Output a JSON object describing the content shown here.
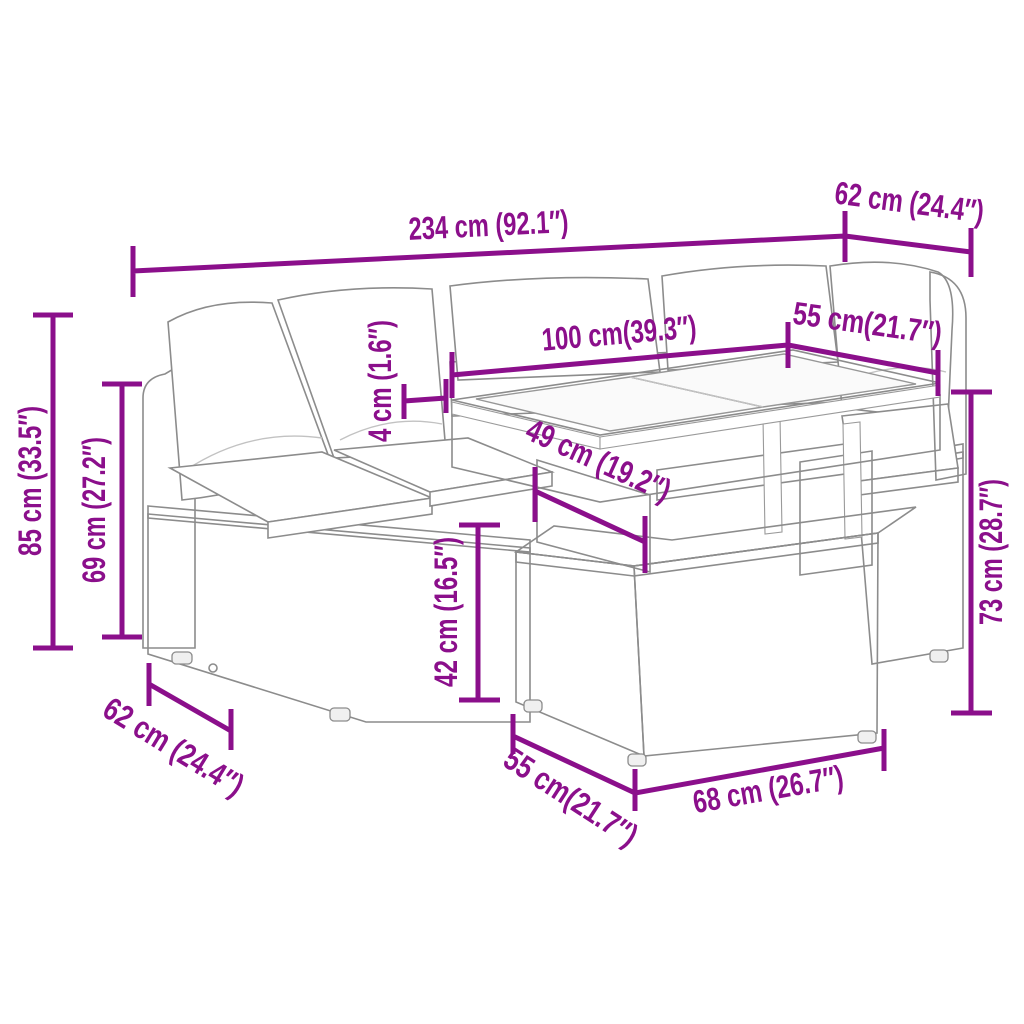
{
  "diagram": {
    "subject": "poly-rattan garden lounge set with glass-top table and footstool",
    "accent_color": "#8B0F8B",
    "outline_color": "#8c8c8c",
    "background_color": "#ffffff",
    "dimensions": {
      "overall_width": "234 cm (92.1″)",
      "corner_depth_top_right": "62 cm (24.4″)",
      "table_length": "100 cm(39.3″)",
      "right_seat_width": "55 cm(21.7″)",
      "glass_top_thickness": "4 cm (1.6″)",
      "table_clearance": "49 cm (19.2″)",
      "overall_height": "85 cm (33.5″)",
      "backrest_height": "69 cm (27.2″)",
      "seat_height": "42 cm (16.5″)",
      "table_height": "73 cm (28.7″)",
      "left_seat_depth": "62 cm (24.4″)",
      "footstool_depth": "55 cm(21.7″)",
      "footstool_width": "68 cm (26.7″)"
    }
  }
}
